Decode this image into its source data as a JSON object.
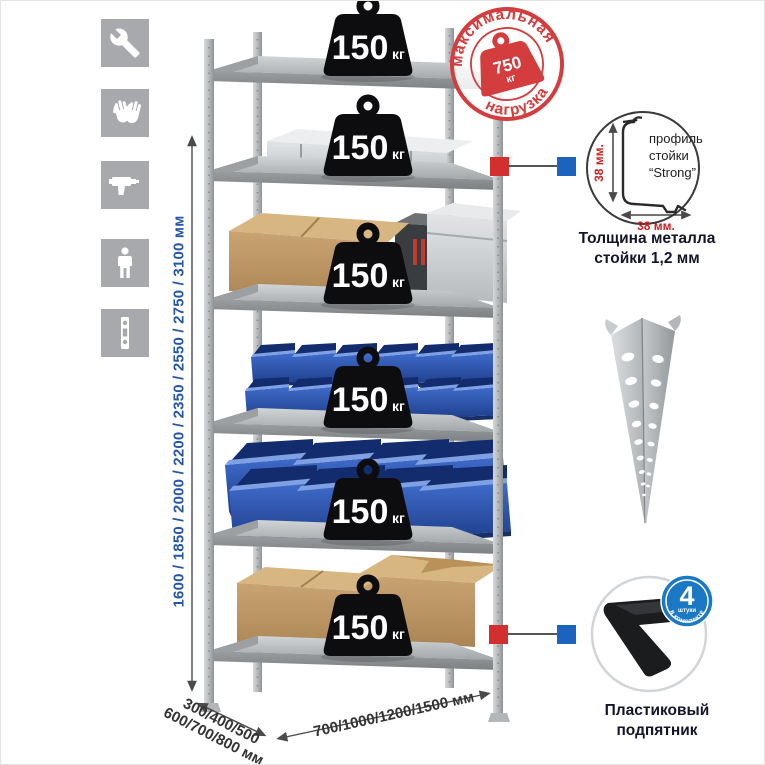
{
  "icons_panel": {
    "items": [
      {
        "name": "wrench-icon"
      },
      {
        "name": "gloves-icon"
      },
      {
        "name": "drill-icon"
      },
      {
        "name": "person-icon"
      },
      {
        "name": "perforated-post-icon"
      }
    ]
  },
  "height_dimension": {
    "label": "1600 / 1850 / 2000 / 2200 / 2350 / 2550 / 2750 / 3100 мм",
    "color": "#2456a4"
  },
  "rack": {
    "shelves_count": 6,
    "load_value": "150",
    "load_unit": "кг"
  },
  "max_load_stamp": {
    "arc_top": "максимальная",
    "arc_bottom": "нагрузка",
    "value": "750",
    "unit": "кг",
    "color": "#d43d3d"
  },
  "profile_detail": {
    "title_line1": "профиль",
    "title_line2": "стойки",
    "title_line3": "“Strong”",
    "vertical_dim": "38 мм.",
    "horizontal_dim": "38 мм.",
    "caption_line1": "Толщина металла",
    "caption_line2": "стойки 1,2 мм"
  },
  "foot_detail": {
    "badge_value": "4",
    "badge_sub": "штуки",
    "badge_arc": "в комплекте",
    "caption_line1": "Пластиковый",
    "caption_line2": "подпятник",
    "badge_color": "#1b78c4"
  },
  "depth_dimension": {
    "line1": "300/400/500",
    "line2": "600/700/800 мм"
  },
  "width_dimension": {
    "label": "700/1000/1200/1500 мм"
  },
  "colors": {
    "icon_gray": "#a7a9ac",
    "metal_gray": "#b9bcbe",
    "bin_blue": "#2d55ae",
    "connector_red": "#d32f2f",
    "connector_blue": "#1b63be"
  }
}
